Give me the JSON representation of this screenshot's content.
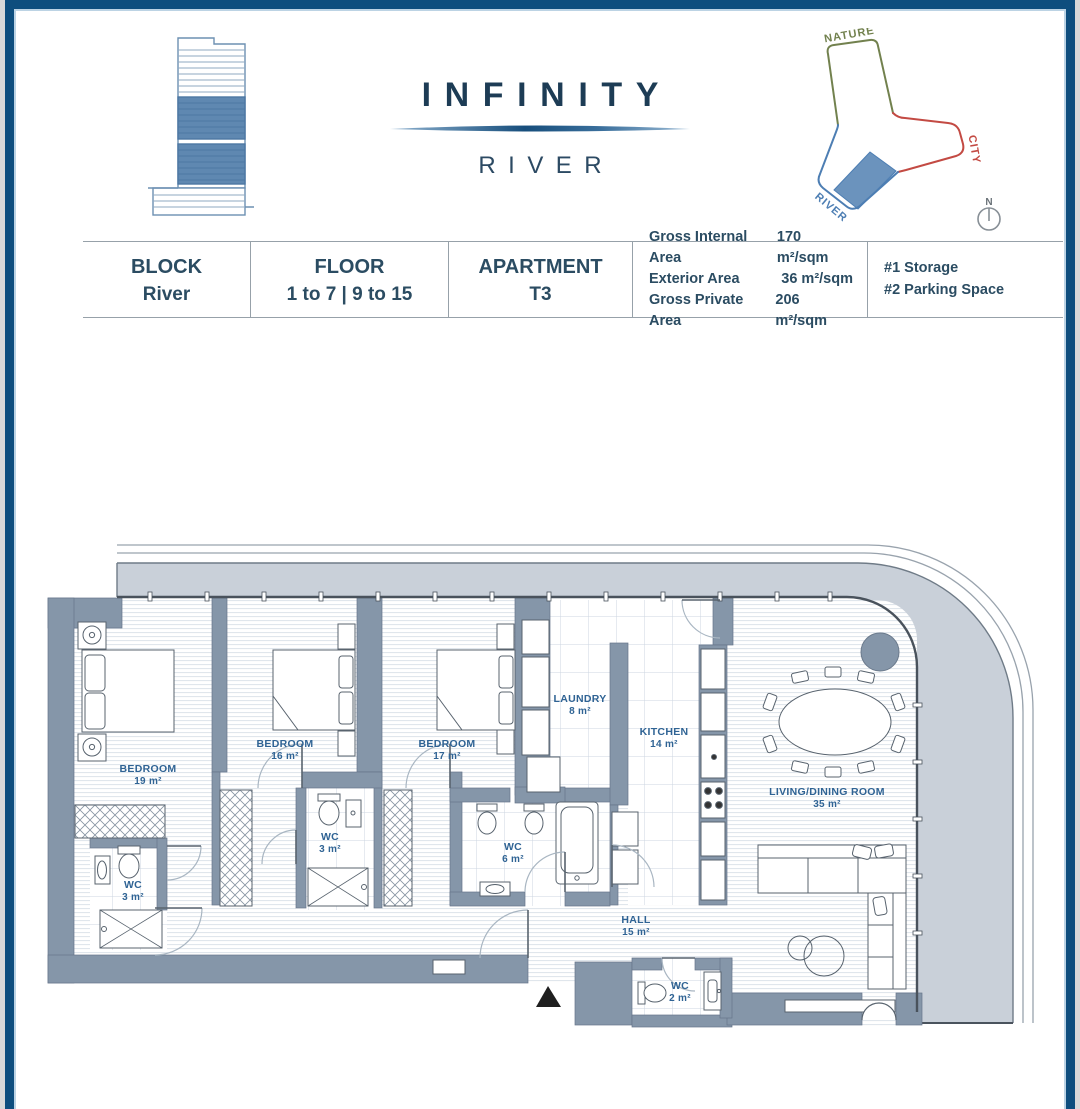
{
  "header": {
    "brand": "INFINITY",
    "brand_sub": "RIVER",
    "site": {
      "nature": "NATURE",
      "city": "CITY",
      "river": "RIVER",
      "compass_north": "N"
    }
  },
  "info": {
    "block_label": "BLOCK",
    "block_value": "River",
    "floor_label": "FLOOR",
    "floor_value": "1 to 7 | 9 to 15",
    "apartment_label": "APARTMENT",
    "apartment_value": "T3",
    "areas": [
      {
        "label": "Gross Internal Area",
        "value": "170 m²/sqm"
      },
      {
        "label": "Exterior Area",
        "value": "36 m²/sqm"
      },
      {
        "label": "Gross Private Area",
        "value": "206 m²/sqm"
      }
    ],
    "extras": [
      {
        "text": "#1 Storage"
      },
      {
        "text": "#2 Parking Space"
      }
    ]
  },
  "plan": {
    "rooms": [
      {
        "name": "BEDROOM",
        "area": "19 m²"
      },
      {
        "name": "BEDROOM",
        "area": "16 m²"
      },
      {
        "name": "BEDROOM",
        "area": "17 m²"
      },
      {
        "name": "LAUNDRY",
        "area": "8 m²"
      },
      {
        "name": "KITCHEN",
        "area": "14 m²"
      },
      {
        "name": "LIVING/DINING ROOM",
        "area": "35 m²"
      },
      {
        "name": "WC",
        "area": "3 m²"
      },
      {
        "name": "WC",
        "area": "3 m²"
      },
      {
        "name": "WC",
        "area": "6 m²"
      },
      {
        "name": "HALL",
        "area": "15 m²"
      },
      {
        "name": "WC",
        "area": "2 m²"
      }
    ]
  },
  "colors": {
    "border_navy": "#0e4e7e",
    "brand_navy": "#1d3c55",
    "wall_slate": "#8596a9",
    "terrace_gray": "#c9d0d9",
    "room_label_blue": "#2f6394",
    "nature_green": "#72814e",
    "city_red": "#c34a43",
    "river_blue": "#4d7eb3"
  }
}
